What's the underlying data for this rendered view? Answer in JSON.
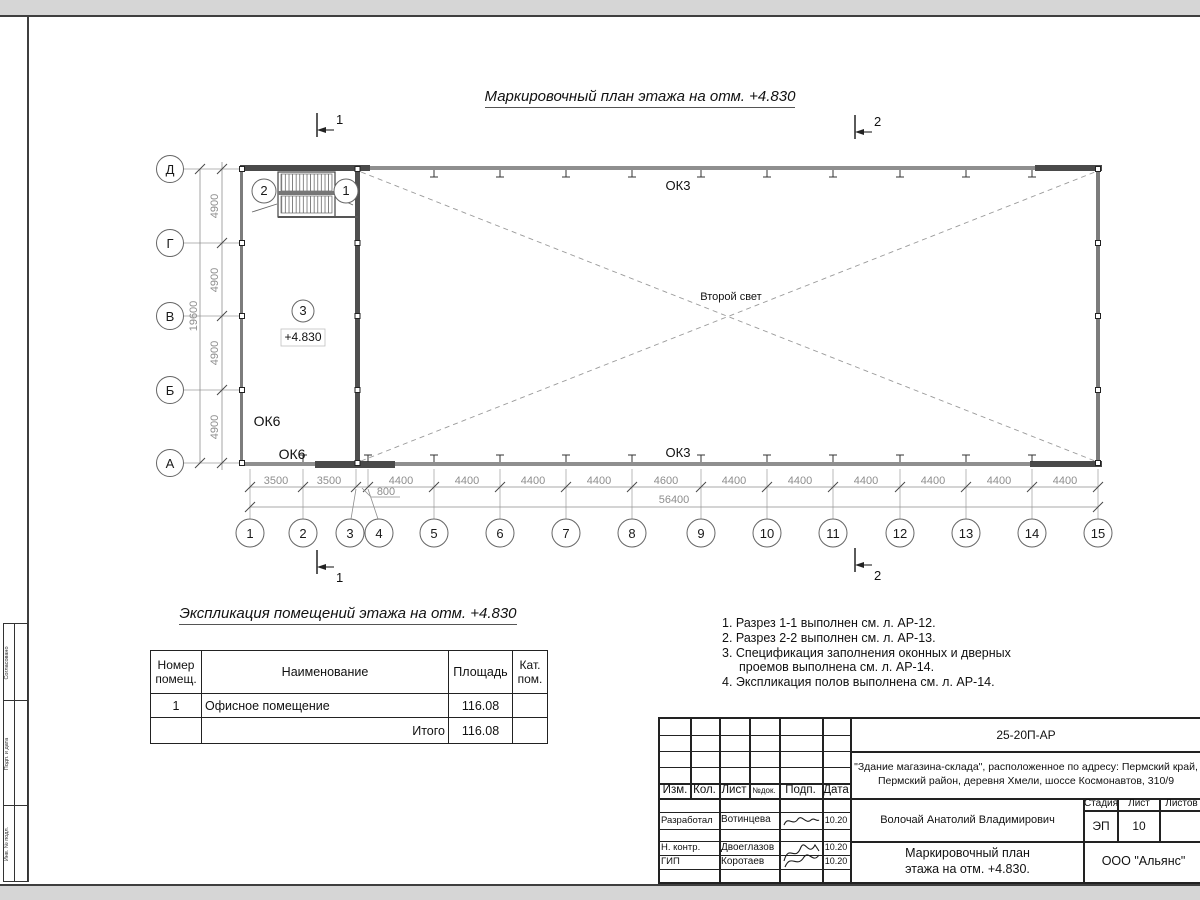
{
  "title": "Маркировочный план этажа на отм. +4.830",
  "plan": {
    "cols": [
      "1",
      "2",
      "3",
      "4",
      "5",
      "6",
      "7",
      "8",
      "9",
      "10",
      "11",
      "12",
      "13",
      "14",
      "15"
    ],
    "rows": [
      "Д",
      "Г",
      "В",
      "Б",
      "А"
    ],
    "span_dims": [
      "3500",
      "3500",
      "800",
      "4400",
      "4400",
      "4400",
      "4400",
      "4600",
      "4400",
      "4400",
      "4400",
      "4400",
      "4400",
      "4400"
    ],
    "total_width": "56400",
    "side_dims": [
      "4900",
      "4900",
      "4900",
      "4900"
    ],
    "total_height": "19600",
    "labels": {
      "ok3_top": "ОК3",
      "ok3_bottom": "ОК3",
      "ok6_upper": "ОК6",
      "ok6_lower": "ОК6",
      "second_light": "Второй свет",
      "elevation": "+4.830",
      "room_number": "3",
      "door_left": "2",
      "door_right": "1"
    },
    "sections": {
      "s1": "1",
      "s2": "2"
    }
  },
  "expl": {
    "title": "Экспликация помещений этажа на отм. +4.830",
    "headers": {
      "num": "Номер помещ.",
      "name": "Наименование",
      "area": "Площадь",
      "cat": "Кат. пом."
    },
    "rows": [
      {
        "num": "1",
        "name": "Офисное помещение",
        "area": "116.08",
        "cat": ""
      }
    ],
    "total_label": "Итого",
    "total_area": "116.08"
  },
  "notes": [
    "1. Разрез 1-1 выполнен см. л. АР-12.",
    "2. Разрез 2-2 выполнен см. л. АР-13.",
    "3. Спецификация заполнения оконных и дверных проемов выполнена см. л. АР-14.",
    "4. Экспликация полов выполнена см. л. АР-14."
  ],
  "titleblock": {
    "doc_code": "25-20П-АР",
    "project_line1": "\"Здание магазина-склада\", расположенное по адресу: Пермский край,",
    "project_line2": "Пермский район, деревня Хмели, шоссе Космонавтов, 310/9",
    "cols": {
      "izm": "Изм.",
      "kol": "Кол.",
      "list": "Лист",
      "ndoc": "№док.",
      "podp": "Подп.",
      "data": "Дата"
    },
    "roles": [
      {
        "role": "Разработал",
        "name": "Вотинцева",
        "date": "10.20"
      },
      {
        "role": "Н. контр.",
        "name": "Двоеглазов",
        "date": "10.20"
      },
      {
        "role": "ГИП",
        "name": "Коротаев",
        "date": "10.20"
      }
    ],
    "chief": "Волочай Анатолий Владимирович",
    "stage_label": "Стадия",
    "sheet_label": "Лист",
    "sheets_label": "Листов",
    "stage": "ЭП",
    "sheet_no": "10",
    "title_line1": "Маркировочный план",
    "title_line2": "этажа на отм. +4.830.",
    "company": "ООО \"Альянс\""
  },
  "side_strip": [
    "Согласовано",
    "Подп. и дата",
    "Инв. № подл."
  ]
}
